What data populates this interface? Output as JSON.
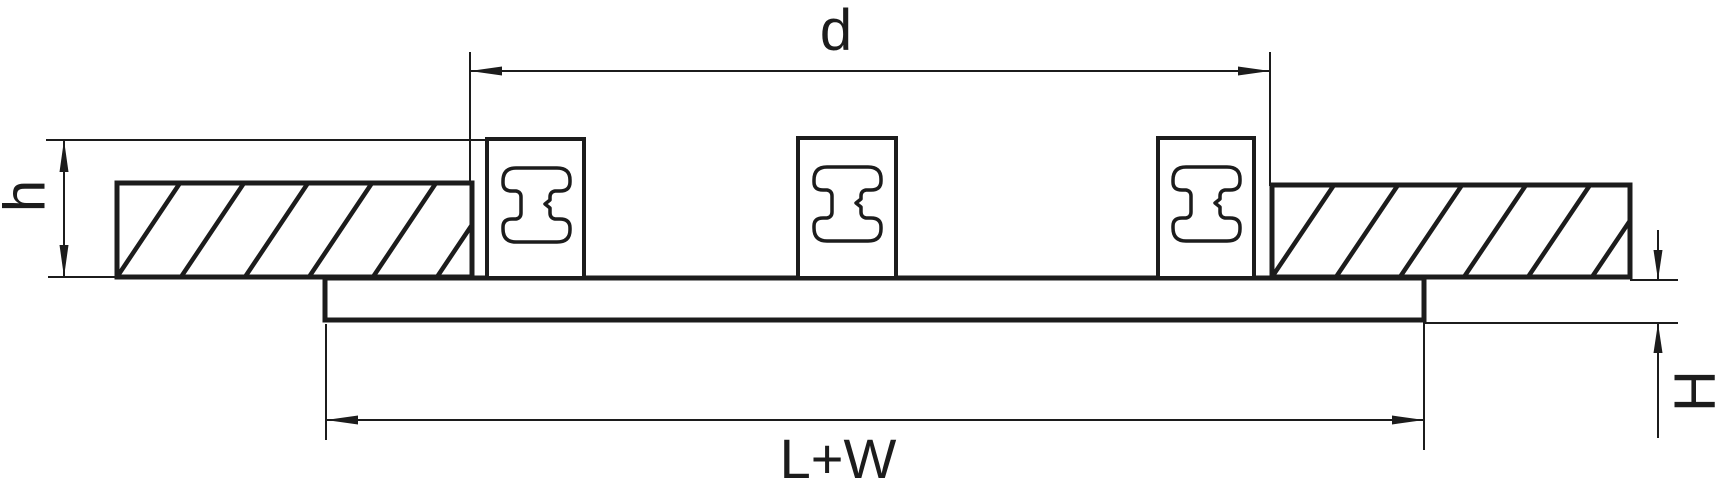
{
  "figure": {
    "type": "technical-dimension-drawing",
    "view": "cross-section",
    "parts": {
      "flange_sections": 2,
      "mounting_clips": 3,
      "plates": 1
    }
  },
  "colors": {
    "background": "#ffffff",
    "line": "#1c1c1c"
  },
  "labels": {
    "top_width": "d",
    "left_height": "h",
    "right_height": "H",
    "bottom_width": "L+W"
  }
}
